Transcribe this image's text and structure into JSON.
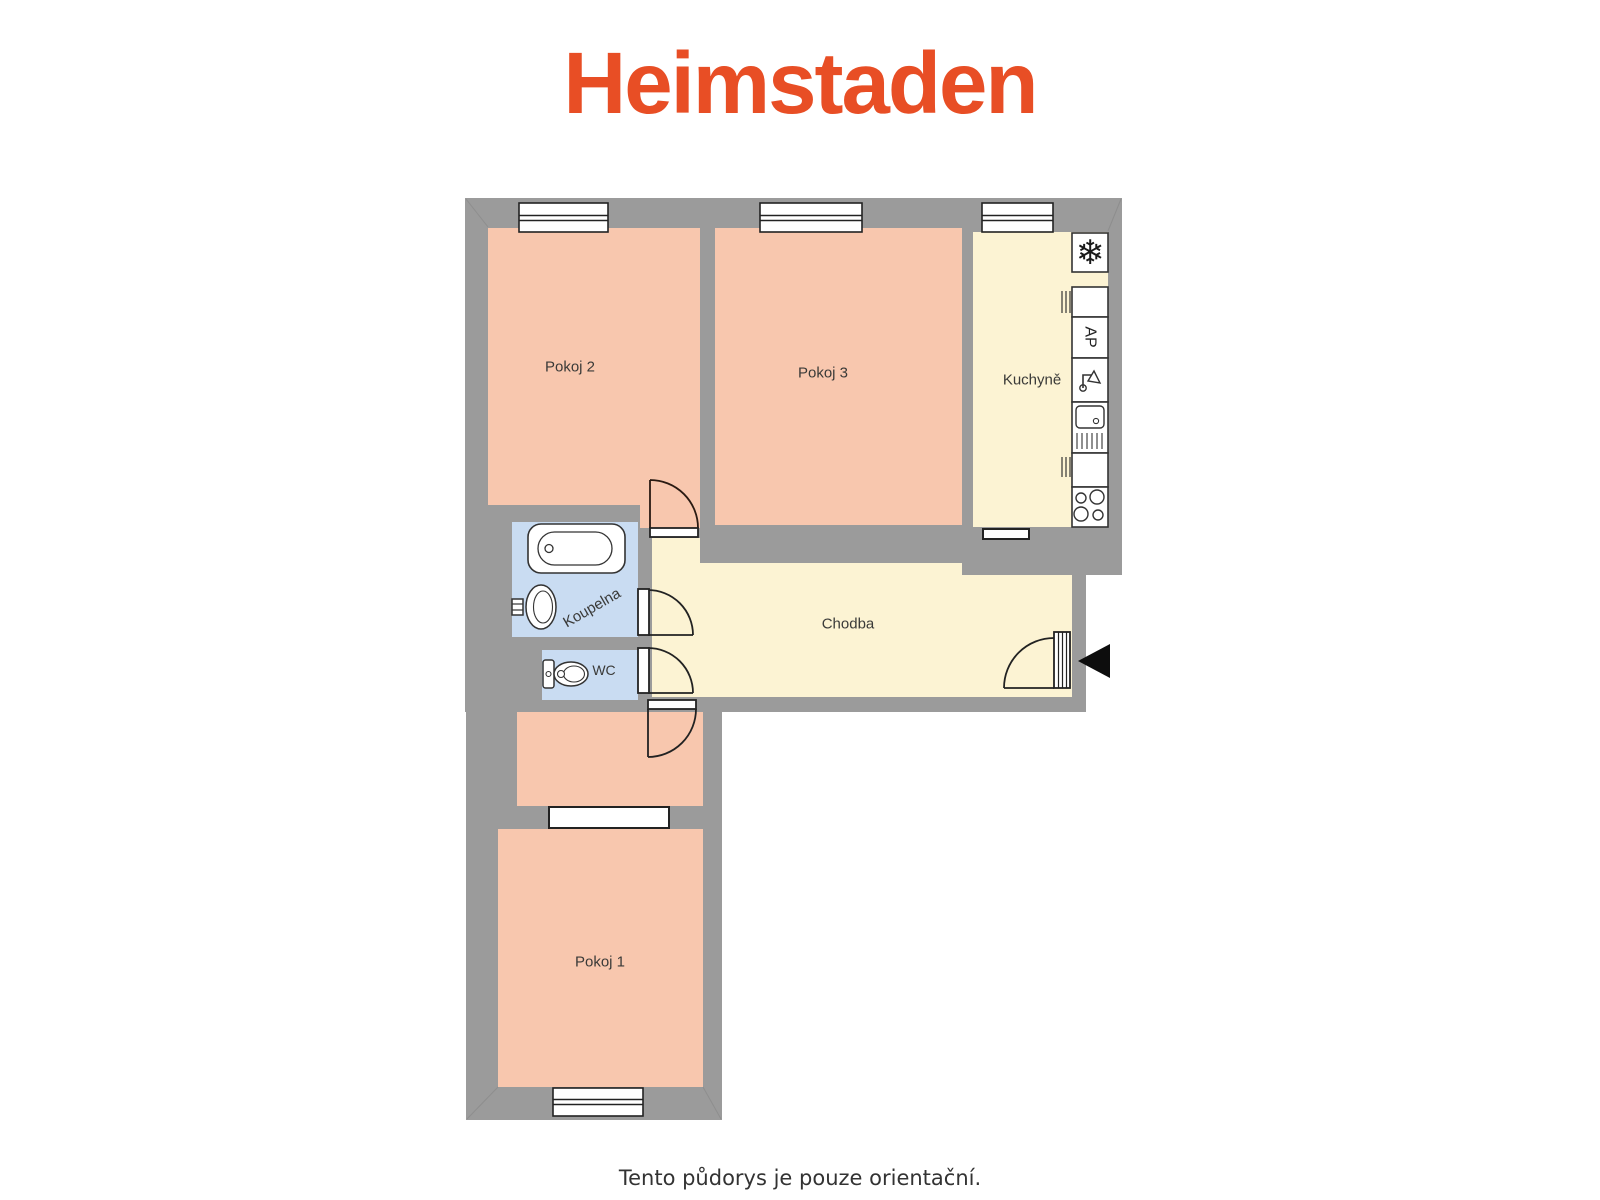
{
  "brand": {
    "name": "Heimstaden",
    "color": "#e84e25"
  },
  "plan": {
    "rooms": [
      {
        "id": "pokoj2",
        "label": "Pokoj 2"
      },
      {
        "id": "pokoj3",
        "label": "Pokoj 3"
      },
      {
        "id": "kuchyne",
        "label": "Kuchyně"
      },
      {
        "id": "chodba",
        "label": "Chodba"
      },
      {
        "id": "koupelna",
        "label": "Koupelna"
      },
      {
        "id": "wc",
        "label": "WC"
      },
      {
        "id": "pokoj1",
        "label": "Pokoj 1"
      }
    ],
    "fixtures": {
      "fridge_icon": "❄",
      "washer_label": "AP",
      "icons": [
        "snowflake-fridge-icon",
        "washer-ap-box",
        "faucet-icon",
        "sink-icon",
        "stove-icon",
        "bathtub-icon",
        "washbasin-icon",
        "toilet-icon",
        "entrance-arrow-icon"
      ]
    },
    "colors": {
      "wall": "#9b9b9b",
      "room_warm": "#f8c7ae",
      "room_light": "#fcf3d3",
      "room_wet": "#c9dcf2",
      "outline": "#222222",
      "arrow": "#0d0d0d"
    }
  },
  "footer": {
    "disclaimer": "Tento půdorys je pouze orientační."
  }
}
